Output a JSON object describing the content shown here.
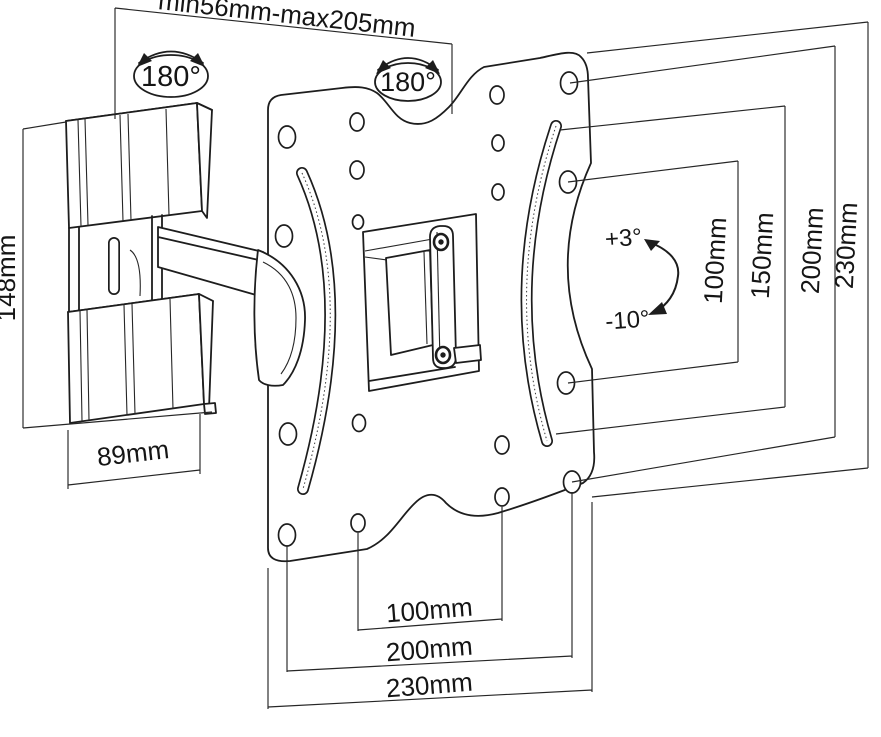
{
  "diagram": {
    "type": "technical-drawing",
    "subject": "Articulating TV wall-mount bracket with dimensions",
    "colors": {
      "line": "#1d1d1d",
      "background": "#ffffff",
      "text": "#151515"
    },
    "annotations": {
      "extension_range": "min56mm-max205mm",
      "swivel_left": "180°",
      "swivel_right": "180°",
      "wall_bracket_height": "148mm",
      "wall_bracket_width": "89mm",
      "tilt_up": "+3°",
      "tilt_down": "-10°",
      "vertical_right": [
        "100mm",
        "150mm",
        "200mm",
        "230mm"
      ],
      "horizontal_bottom": [
        "100mm",
        "200mm",
        "230mm"
      ]
    }
  }
}
